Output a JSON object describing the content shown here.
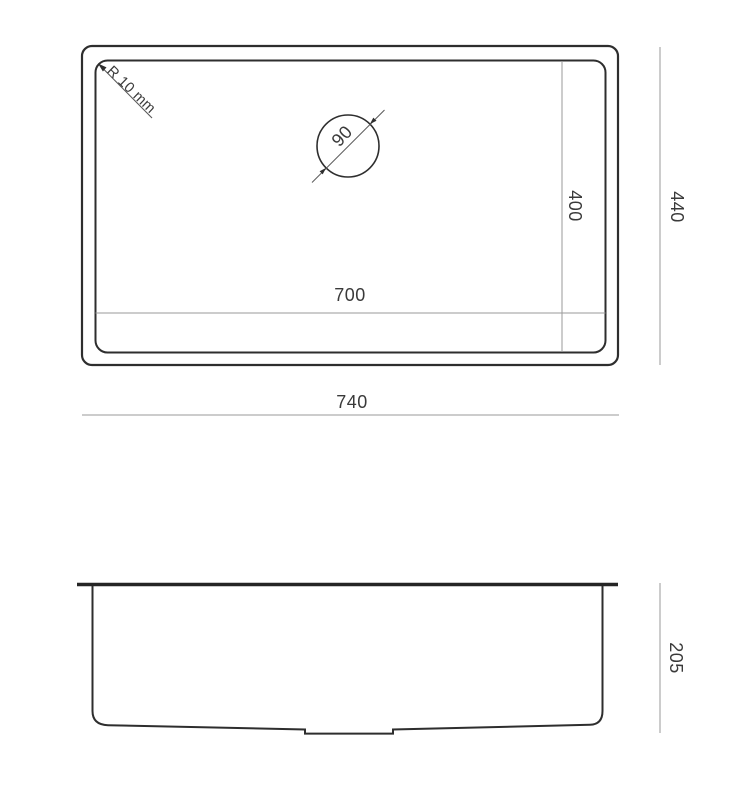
{
  "drawing": {
    "colors": {
      "background": "#ffffff",
      "outline": "#2e2e2e",
      "dimension_line": "#9a9a9a",
      "annotation_line": "#5a5a5a",
      "text": "#3a3a3a"
    },
    "top_view": {
      "outer_width_label": "740",
      "outer_depth_label": "440",
      "bowl_width_label": "700",
      "bowl_depth_label": "400",
      "corner_radius_label": "R 10 mm",
      "drain_diameter_label": "90"
    },
    "side_view": {
      "height_label": "205"
    }
  }
}
